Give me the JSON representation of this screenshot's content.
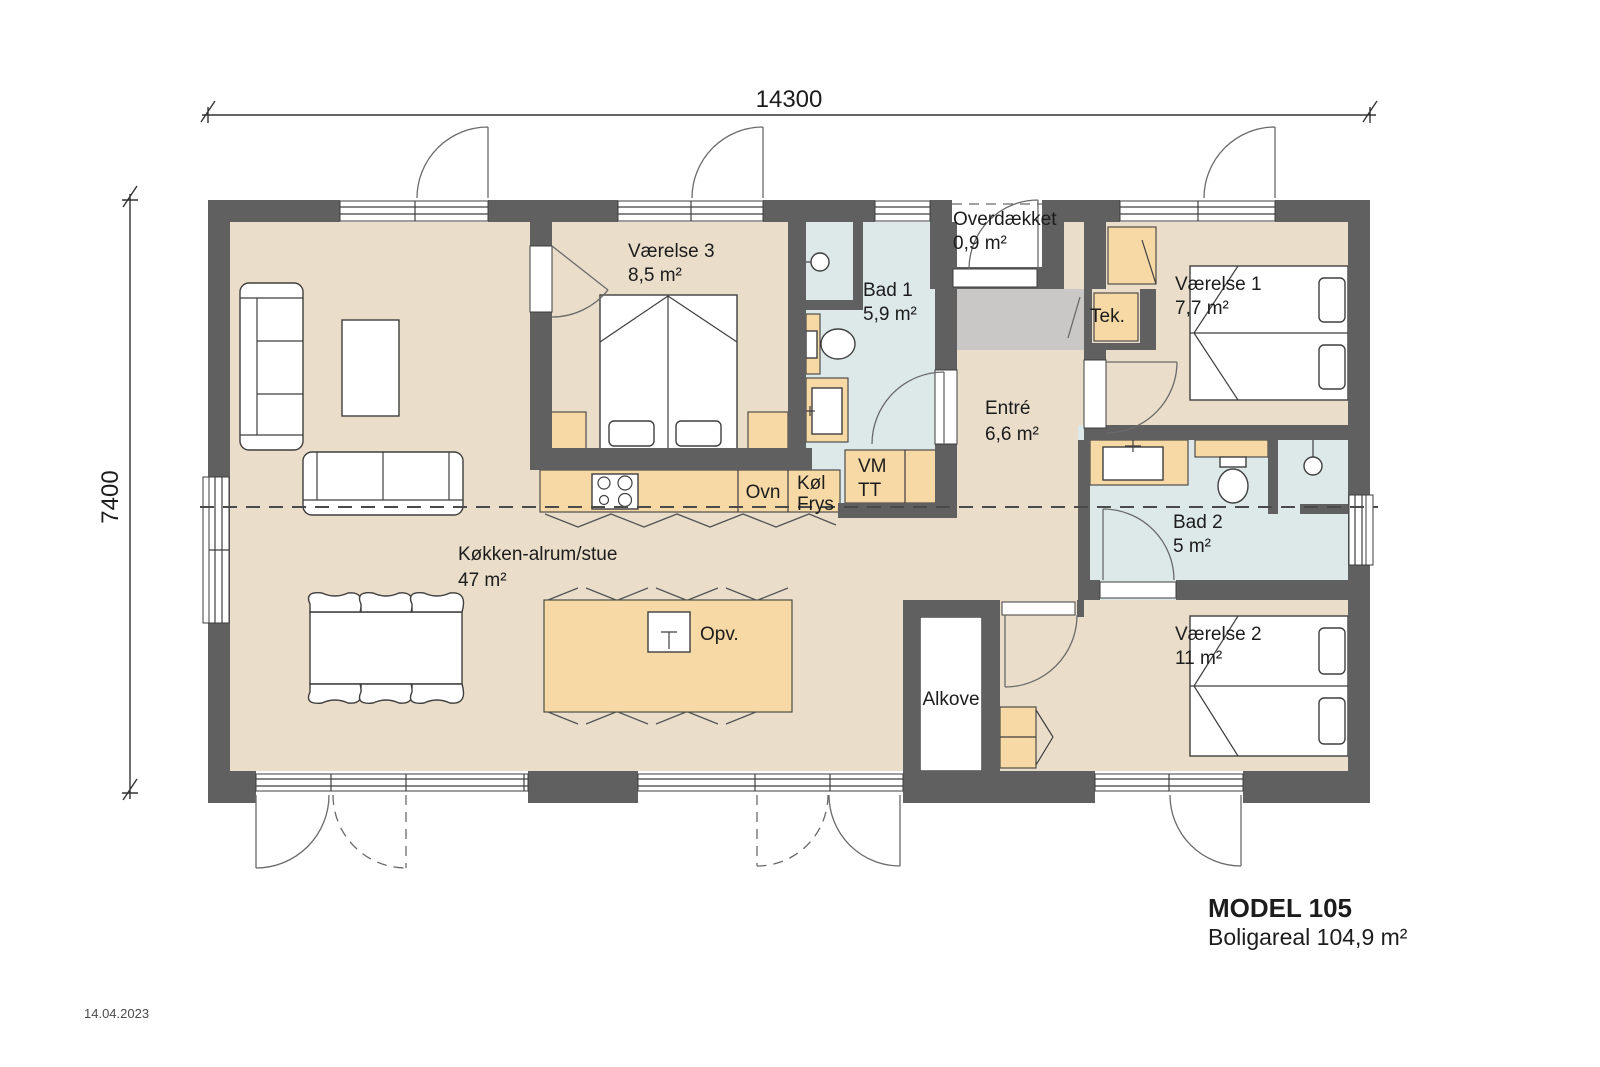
{
  "meta": {
    "date": "14.04.2023"
  },
  "dimensions": {
    "width_mm": "14300",
    "height_mm": "7400"
  },
  "title_block": {
    "model": "MODEL 105",
    "area_line": "Boligareal 104,9 m²"
  },
  "rooms": {
    "koekken": {
      "name": "Køkken-alrum/stue",
      "area": "47 m²"
    },
    "vaerelse3": {
      "name": "Værelse 3",
      "area": "8,5 m²"
    },
    "bad1": {
      "name": "Bad 1",
      "area": "5,9 m²"
    },
    "overdaekket": {
      "name": "Overdækket",
      "area": "0,9 m²"
    },
    "tek": {
      "name": "Tek."
    },
    "vaerelse1": {
      "name": "Værelse 1",
      "area": "7,7 m²"
    },
    "entre": {
      "name": "Entré",
      "area": "6,6 m²"
    },
    "bad2": {
      "name": "Bad 2",
      "area": "5 m²"
    },
    "vaerelse2": {
      "name": "Værelse 2",
      "area": "11 m²"
    },
    "alkove": {
      "name": "Alkove"
    }
  },
  "appliances": {
    "ovn": "Ovn",
    "koel": "Køl",
    "frys": "Frys",
    "vm": "VM",
    "tt": "TT",
    "opv": "Opv."
  },
  "colors": {
    "wall": "#606060",
    "floor": "#eaddc9",
    "bath_floor": "#dde8e8",
    "cabinet": "#f7d9a6",
    "entrance_mat": "#c9c8c6"
  }
}
